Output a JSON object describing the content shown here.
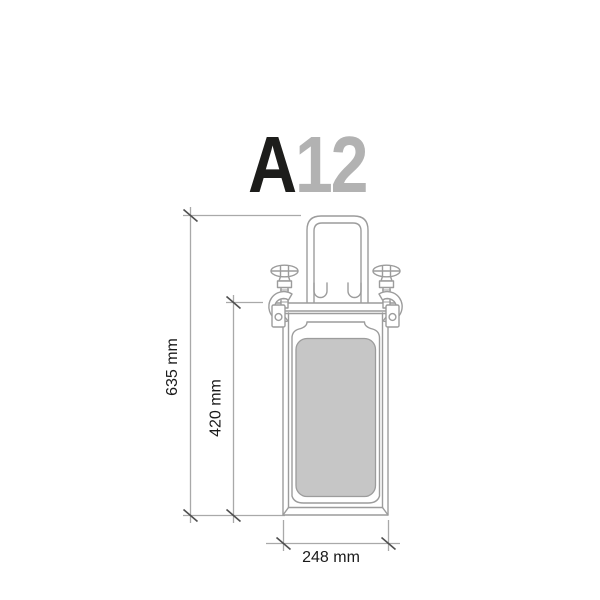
{
  "title": {
    "series": "A",
    "number": "12"
  },
  "dimensions": {
    "overall_height": "635 mm",
    "inner_height": "420 mm",
    "width": "248 mm"
  },
  "colors": {
    "outline": "#9c9c9c",
    "dimension_line": "#a9a9a9",
    "tick": "#4f4f4f",
    "panel_fill": "#c6c6c6",
    "label_text": "#1a1a1a",
    "title_series": "#1d1d1b",
    "title_number": "#b2b2b2",
    "background": "#ffffff"
  }
}
